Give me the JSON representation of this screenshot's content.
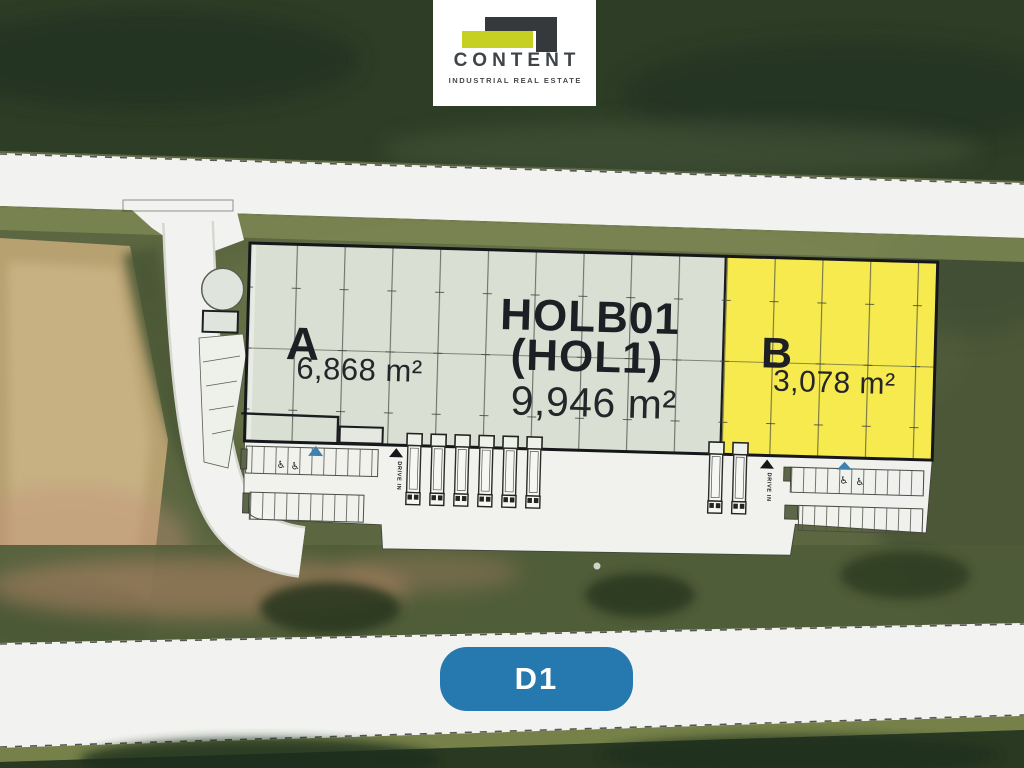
{
  "brand": {
    "name": "CONTENT",
    "tagline": "INDUSTRIAL REAL ESTATE"
  },
  "hall": {
    "code_line1": "HOLB01",
    "code_line2": "(HOL1)",
    "total_area": "9,946 m²"
  },
  "units": [
    {
      "id": "A",
      "label": "A",
      "area": "6,868 m²",
      "fill": "#d9dfd3"
    },
    {
      "id": "B",
      "label": "B",
      "area": "3,078 m²",
      "fill": "#f6ea4e"
    }
  ],
  "markers": {
    "drive_in": "DRIVE IN"
  },
  "highway_badge": {
    "label": "D1",
    "color": "#2579ae"
  },
  "palette": {
    "logo_green": "#c5d022",
    "logo_charcoal": "#35393c",
    "plan_text": "#1d1f24",
    "road_white": "#f2f3f0",
    "accent_blue": "#3f80ad"
  }
}
